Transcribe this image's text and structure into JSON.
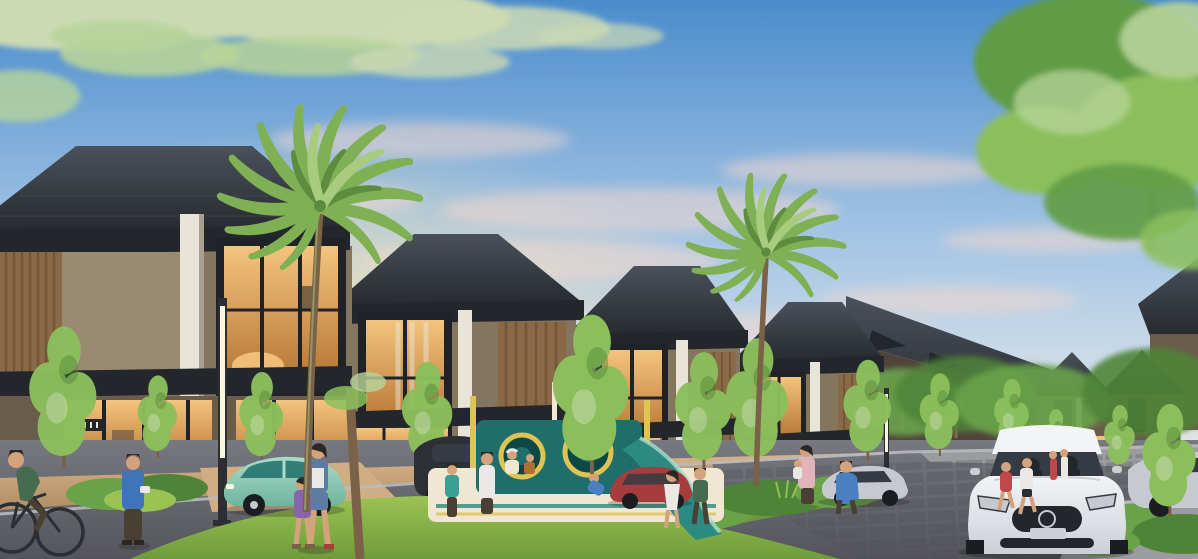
{
  "scene": {
    "title": "Modern townhouse residential development - dusk street rendering",
    "description": "Architectural rendering of a receding row of modern two-storey townhouses at dusk with warm lit interiors, wooden slat screens, tall palm trees, light-green street trees, a teal playground with porthole panel and slide on a grass mound, a mint hatchback, a red car, a white sedan driving toward the viewer, pedestrians, children, joggers and a cyclist along a curved paved street.",
    "time_of_day": "dusk",
    "elements": [
      "sky with pink clouds and warm horizon glow",
      "overhanging foliage top-left",
      "large green tree top-right",
      "row of four foreground townhouses",
      "receding townhouse block",
      "background detached house with twin gables",
      "far-right house fragment",
      "two fern palm trees",
      "light green street trees",
      "street lamps with glowing strips",
      "teal playground with two portholes and slide",
      "foreground grass mound",
      "planting beds and shrubs",
      "mint hatchback, dark SUV, red car, small silver car, silver sports car, white sedan, silver car at right edge",
      "cyclist, standing man in blue, woman with child, children playing, woman with toddler, sitting person, two joggers, distant couple"
    ]
  },
  "colors": {
    "sky_top": "#4a8ccc",
    "sky_mid": "#a3c4e4",
    "sky_low": "#d9e3ea",
    "sky_horizon": "#efe6d3",
    "glow": "#f9e6ae",
    "cloud": "#f2d8ce",
    "haze": "#e8e2da",
    "roof_light": "#4a515a",
    "roof_dark": "#262a2f",
    "fascia": "#23272c",
    "wall": "#84755f",
    "wall_light": "#9b8a72",
    "wall_dark": "#6a5c4a",
    "wall_shadow": "#50443a",
    "slat": "#8a6a46",
    "slat_dark": "#6e5335",
    "trim": "#e9e4d8",
    "frame": "#1f2226",
    "glass_top": "#f4c47d",
    "glass_bot": "#b06f2e",
    "glass_dim": "#c78845",
    "grass_light": "#9ac353",
    "grass_dark": "#6f9c3a",
    "road_light": "#787880",
    "road_dark": "#54555b",
    "paver": "#4e4f55",
    "curb": "#b9babc",
    "sidewalk": "#9a9ca0",
    "path_light": "#d8b488",
    "path_dark": "#b08e66",
    "drive": "#cfae83",
    "play_teal": "#1f6e6b",
    "slide_teal": "#2c8a82",
    "play_yellow": "#ddc453",
    "play_cream": "#efe7d2",
    "porthole": "#0d4746",
    "car_mint": "#aadcc8",
    "car_mint_dark": "#6fb49e",
    "car_red": "#a73c3f",
    "car_silver": "#c6cad0",
    "car_dark": "#2c2f34",
    "car_white": "#f2f4f6",
    "car_white_shade": "#ccd0d6",
    "grille": "#23262b",
    "glass_car": "#343b44",
    "tyre": "#1b1e21",
    "skin": "#d4a27c",
    "hair": "#2e2622",
    "denim": "#5e7ca3",
    "purple": "#8a63b0",
    "blue_shirt": "#3f74b8",
    "teal_shirt": "#3aa096",
    "red_top": "#c04848",
    "white_cloth": "#eae8e4",
    "green_shirt": "#466b4e",
    "pink": "#e3b3bc",
    "blue_sit": "#4a7fc0",
    "pants": "#4a3f33",
    "tree_green": "#8cbf5c",
    "tree_dark": "#5f9c44",
    "tree_light": "#b7d49a",
    "foliage_pale": "#ccdab4",
    "bush": "#6aa24a",
    "bush_dark": "#4f8438",
    "trunk": "#7a6148",
    "palm_green": "#7fb054",
    "palm_dark": "#5d8c3e",
    "palm_light": "#a8cc7e",
    "pole": "#2b2e33",
    "light_strip": "#fdf6df",
    "shadow": "#1a1a1a"
  }
}
